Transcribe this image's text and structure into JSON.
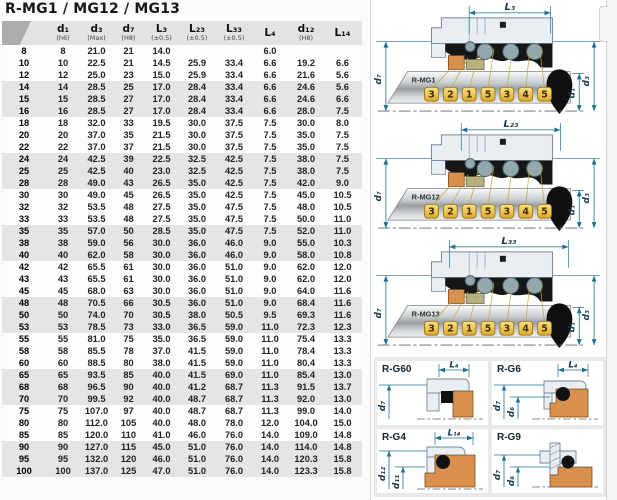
{
  "title": "R-MG1 / MG12 / MG13",
  "table": {
    "columns": [
      {
        "label": "",
        "note": ""
      },
      {
        "label": "d₁",
        "note": "(h6)"
      },
      {
        "label": "d₃",
        "note": "(Max)"
      },
      {
        "label": "d₇",
        "note": "(H8)"
      },
      {
        "label": "L₃",
        "note": "(±0.5)"
      },
      {
        "label": "L₂₃",
        "note": "(±0.5)"
      },
      {
        "label": "L₃₃",
        "note": "(±0.5)"
      },
      {
        "label": "L₄",
        "note": ""
      },
      {
        "label": "d₁₂",
        "note": "(H8)"
      },
      {
        "label": "L₁₄",
        "note": ""
      }
    ],
    "rows": [
      [
        "8",
        "8",
        "21.0",
        "21",
        "14.0",
        "",
        "",
        "6.0",
        "",
        ""
      ],
      [
        "10",
        "10",
        "22.5",
        "21",
        "14.5",
        "25.9",
        "33.4",
        "6.6",
        "19.2",
        "6.6"
      ],
      [
        "12",
        "12",
        "25.0",
        "23",
        "15.0",
        "25.9",
        "33.4",
        "6.6",
        "21.6",
        "5.6"
      ],
      [
        "14",
        "14",
        "28.5",
        "25",
        "17.0",
        "28.4",
        "33.4",
        "6.6",
        "24.6",
        "5.6"
      ],
      [
        "15",
        "15",
        "28.5",
        "27",
        "17.0",
        "28.4",
        "33.4",
        "6.6",
        "24.6",
        "6.6"
      ],
      [
        "16",
        "16",
        "28.5",
        "27",
        "17.0",
        "28.4",
        "33.4",
        "6.6",
        "28.0",
        "7.5"
      ],
      [
        "18",
        "18",
        "32.0",
        "33",
        "19.5",
        "30.0",
        "37.5",
        "7.5",
        "30.0",
        "8.0"
      ],
      [
        "20",
        "20",
        "37.0",
        "35",
        "21.5",
        "30.0",
        "37.5",
        "7.5",
        "35.0",
        "7.5"
      ],
      [
        "22",
        "22",
        "37.0",
        "37",
        "21.5",
        "30.0",
        "37.5",
        "7.5",
        "35.0",
        "7.5"
      ],
      [
        "24",
        "24",
        "42.5",
        "39",
        "22.5",
        "32.5",
        "42.5",
        "7.5",
        "38.0",
        "7.5"
      ],
      [
        "25",
        "25",
        "42.5",
        "40",
        "23.0",
        "32.5",
        "42.5",
        "7.5",
        "38.0",
        "7.5"
      ],
      [
        "28",
        "28",
        "49.0",
        "43",
        "26.5",
        "35.0",
        "42.5",
        "7.5",
        "42.0",
        "9.0"
      ],
      [
        "30",
        "30",
        "49.0",
        "45",
        "26.5",
        "35.0",
        "42.5",
        "7.5",
        "45.0",
        "10.5"
      ],
      [
        "32",
        "32",
        "53.5",
        "48",
        "27.5",
        "35.0",
        "47.5",
        "7.5",
        "48.0",
        "10.5"
      ],
      [
        "33",
        "33",
        "53.5",
        "48",
        "27.5",
        "35.0",
        "47.5",
        "7.5",
        "50.0",
        "11.0"
      ],
      [
        "35",
        "35",
        "57.0",
        "50",
        "28.5",
        "35.0",
        "47.5",
        "7.5",
        "52.0",
        "11.0"
      ],
      [
        "38",
        "38",
        "59.0",
        "56",
        "30.0",
        "36.0",
        "46.0",
        "9.0",
        "55.0",
        "10.3"
      ],
      [
        "40",
        "40",
        "62.0",
        "58",
        "30.0",
        "36.0",
        "46.0",
        "9.0",
        "58.0",
        "10.8"
      ],
      [
        "42",
        "42",
        "65.5",
        "61",
        "30.0",
        "36.0",
        "51.0",
        "9.0",
        "62.0",
        "12.0"
      ],
      [
        "43",
        "43",
        "65.5",
        "61",
        "30.0",
        "36.0",
        "51.0",
        "9.0",
        "62.0",
        "12.0"
      ],
      [
        "45",
        "45",
        "68.0",
        "63",
        "30.0",
        "36.0",
        "51.0",
        "9.0",
        "64.0",
        "11.6"
      ],
      [
        "48",
        "48",
        "70.5",
        "66",
        "30.5",
        "36.0",
        "51.0",
        "9.0",
        "68.4",
        "11.6"
      ],
      [
        "50",
        "50",
        "74.0",
        "70",
        "30.5",
        "38.0",
        "50.5",
        "9.5",
        "69.3",
        "11.6"
      ],
      [
        "53",
        "53",
        "78.5",
        "73",
        "33.0",
        "36.5",
        "59.0",
        "11.0",
        "72.3",
        "12.3"
      ],
      [
        "55",
        "55",
        "81.0",
        "75",
        "35.0",
        "36.5",
        "59.0",
        "11.0",
        "75.4",
        "13.3"
      ],
      [
        "58",
        "58",
        "85.5",
        "78",
        "37.0",
        "41.5",
        "59.0",
        "11.0",
        "78.4",
        "13.3"
      ],
      [
        "60",
        "60",
        "88.5",
        "80",
        "38.0",
        "41.5",
        "59.0",
        "11.0",
        "80.4",
        "13.3"
      ],
      [
        "65",
        "65",
        "93.5",
        "85",
        "40.0",
        "41.5",
        "69.0",
        "11.0",
        "85.4",
        "13.0"
      ],
      [
        "68",
        "68",
        "96.5",
        "90",
        "40.0",
        "41.2",
        "68.7",
        "11.3",
        "91.5",
        "13.7"
      ],
      [
        "70",
        "70",
        "99.5",
        "92",
        "40.0",
        "48.7",
        "68.7",
        "11.3",
        "92.0",
        "13.0"
      ],
      [
        "75",
        "75",
        "107.0",
        "97",
        "40.0",
        "48.7",
        "68.7",
        "11.3",
        "99.0",
        "14.0"
      ],
      [
        "80",
        "80",
        "112.0",
        "105",
        "40.0",
        "48.0",
        "78.0",
        "12.0",
        "104.0",
        "15.0"
      ],
      [
        "85",
        "85",
        "120.0",
        "110",
        "41.0",
        "46.0",
        "76.0",
        "14.0",
        "109.0",
        "14.8"
      ],
      [
        "90",
        "90",
        "127.0",
        "115",
        "45.0",
        "51.0",
        "76.0",
        "14.0",
        "114.0",
        "14.8"
      ],
      [
        "95",
        "95",
        "132.0",
        "120",
        "46.0",
        "51.0",
        "76.0",
        "14.0",
        "120.3",
        "15.8"
      ],
      [
        "100",
        "100",
        "137.0",
        "125",
        "47.0",
        "51.0",
        "76.0",
        "14.0",
        "123.3",
        "15.8"
      ]
    ]
  },
  "diagrams": [
    {
      "label": "R-MG1",
      "top_dim": "L₃",
      "left_dim": "d₇",
      "right_dims": [
        "d₁",
        "d₃"
      ],
      "callouts": [
        "3",
        "2",
        "1",
        "5",
        "3",
        "4",
        "5"
      ]
    },
    {
      "label": "R-MG12",
      "top_dim": "L₂₃",
      "left_dim": "d₇",
      "right_dims": [
        "d₁",
        "d₃"
      ],
      "callouts": [
        "3",
        "2",
        "1",
        "5",
        "3",
        "4",
        "5"
      ]
    },
    {
      "label": "R-MG13",
      "top_dim": "L₃₃",
      "left_dim": "d₇",
      "right_dims": [
        "d₁",
        "d₃"
      ],
      "callouts": [
        "3",
        "2",
        "1",
        "5",
        "3",
        "4",
        "5"
      ]
    }
  ],
  "detail_views": [
    {
      "label": "R-G60",
      "top_dim": "L₄",
      "left_dims": [
        "d₇"
      ]
    },
    {
      "label": "R-G6",
      "top_dim": "L₄",
      "left_dims": [
        "d₇",
        "d₆"
      ]
    },
    {
      "label": "R-G4",
      "top_dim": "L₁₄",
      "left_dims": [
        "d₁₂",
        "d₁₁"
      ]
    },
    {
      "label": "R-G9",
      "top_dim": "",
      "left_dims": [
        "d₇",
        "d₆"
      ]
    }
  ],
  "colors": {
    "dim_line": "#1d6e90",
    "callout_chip": "#eec654",
    "seat_orange": "#d98f4e",
    "seat_olive": "#b6b183",
    "elastomer_black": "#161616",
    "housing_light": "#e9eef3",
    "steel_mid": "#9aa1a6",
    "header_gray": "#e3e3e3",
    "band_gray": "#e5e5e5"
  }
}
